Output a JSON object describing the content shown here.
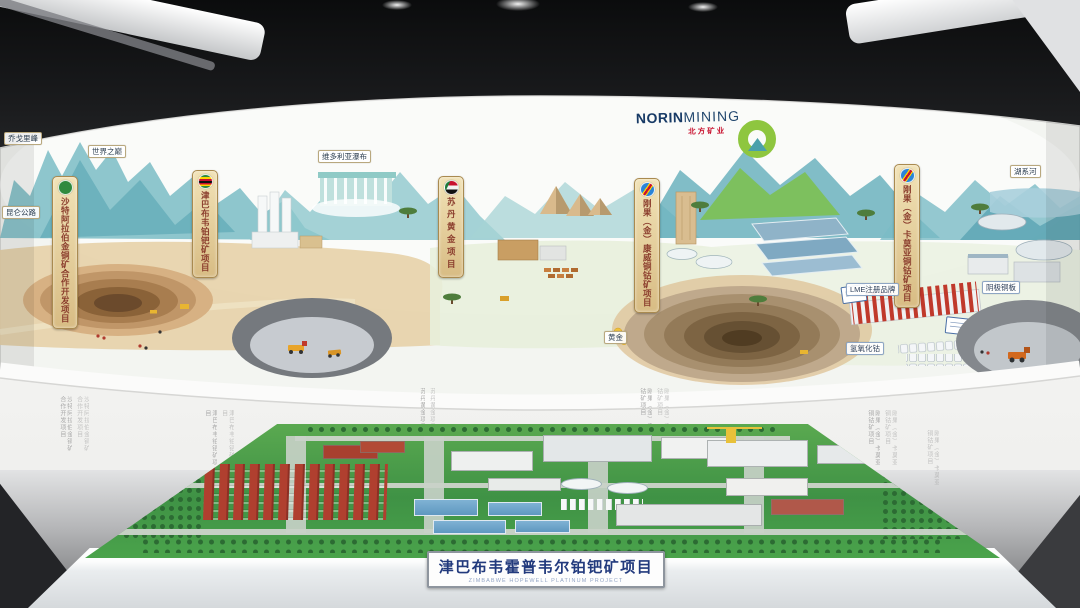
{
  "exhibit": {
    "logo": {
      "name_bold": "NORIN",
      "name_light": "MINING",
      "cn": "北方矿业"
    },
    "banners": [
      {
        "country": "saudi-arabia",
        "label": "沙特阿拉伯金铜矿合作开发项目"
      },
      {
        "country": "zimbabwe",
        "label": "津巴布韦铂钯矿项目"
      },
      {
        "country": "sudan",
        "label": "苏丹黄金项目"
      },
      {
        "country": "drc",
        "label": "刚果（金）康威铜钴矿项目"
      },
      {
        "country": "drc",
        "label": "刚果（金）卡莫亚铜钴矿项目"
      }
    ],
    "map_labels": {
      "peak": "乔戈里峰",
      "world_roof": "世界之巅",
      "kunlun_road": "昆仑公路",
      "victoria_falls": "维多利亚瀑布",
      "river": "湖系河",
      "lme": "LME注册品牌",
      "cobalt_hydroxide": "氢氧化钴",
      "copper_cathode": "阴极铜板",
      "gold": "黄金"
    },
    "wall_texts": [
      "沙特阿拉伯金铜矿合作开发项目",
      "津巴布韦铂钯矿项目",
      "苏丹黄金项目",
      "刚果（金）康威铜钴矿项目",
      "刚果（金）卡莫亚铜钴矿项目",
      "刚果（金）卡莫亚铜钴矿项目"
    ],
    "model_plate": {
      "cn": "津巴布韦霍普韦尔铂钯矿项目",
      "en": "ZIMBABWE HOPEWELL PLATINUM PROJECT"
    }
  },
  "colors": {
    "accent_green": "#8ec63f",
    "brand_navy": "#173a66",
    "brand_red": "#c8102e",
    "plate_blue": "#223a7d"
  }
}
